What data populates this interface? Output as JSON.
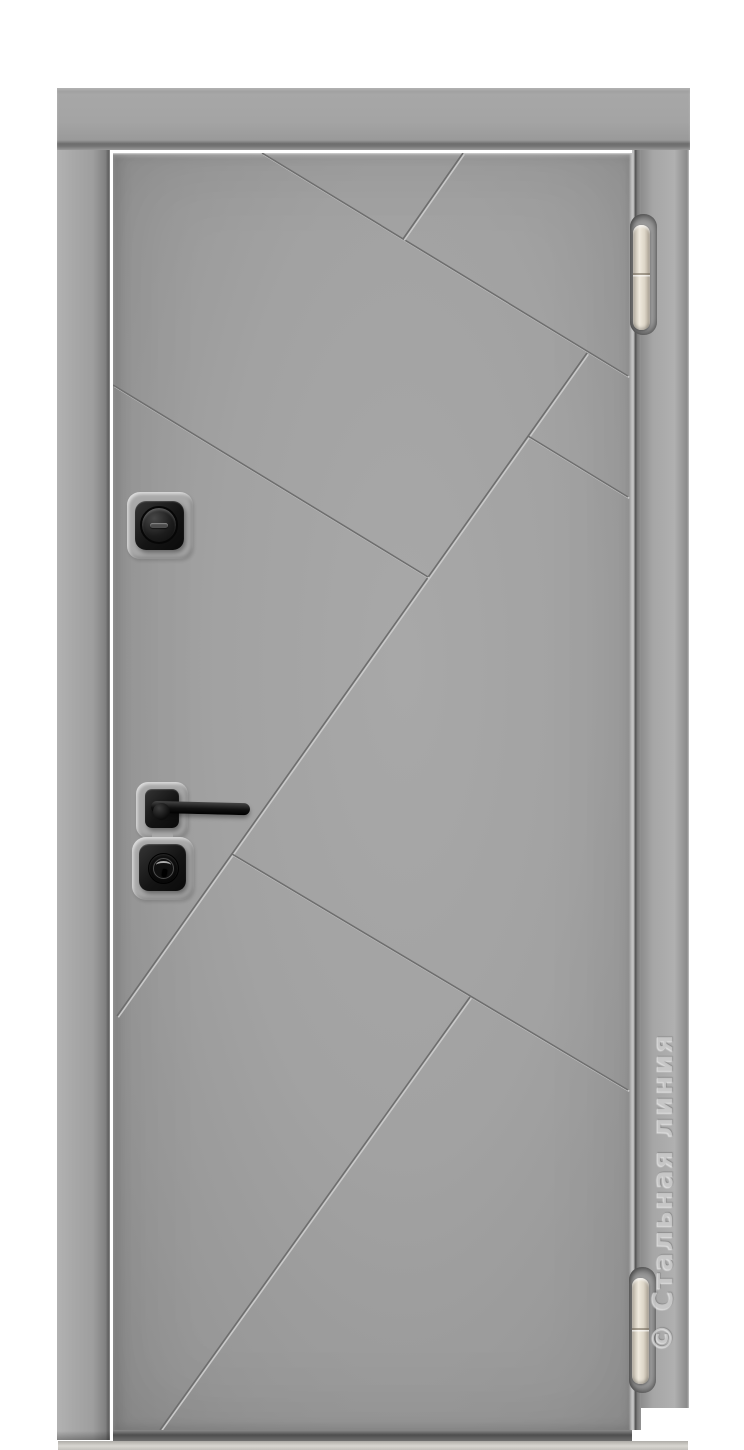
{
  "image": {
    "description": "Product photograph of a grey steel entrance door, exterior side, with diagonal milled groove pattern",
    "background_color": "#ffffff"
  },
  "watermark": {
    "text": "© Стальная линия",
    "orientation": "vertical, reads bottom to top along right door frame",
    "color": "#e0e0e0"
  },
  "door": {
    "leaf_color": "#a0a0a0",
    "frame_color": "#a8a8a8",
    "groove_dark_color": "#6e6e6e",
    "groove_light_color": "#c9c9c9",
    "sill_color": "#d0cec9",
    "hardware_color": "#141414",
    "hinge_color": "#e9e3d7",
    "hinges": [
      {
        "id": "top",
        "position": "upper right"
      },
      {
        "id": "bottom",
        "position": "lower right"
      }
    ],
    "hardware": [
      {
        "id": "thumbturn-lock",
        "type": "night-lock thumbturn on square black escutcheon"
      },
      {
        "id": "door-handle",
        "type": "straight lever handle on square black rose"
      },
      {
        "id": "cylinder-lock",
        "type": "key cylinder on square black escutcheon"
      }
    ]
  },
  "pattern": {
    "grooves": [
      {
        "x1": 149,
        "y1": 0,
        "x2": 515,
        "y2": 223
      },
      {
        "x1": 290,
        "y1": 86,
        "x2": 350,
        "y2": 0
      },
      {
        "x1": 474,
        "y1": 200,
        "x2": 4,
        "y2": 863
      },
      {
        "x1": 0,
        "y1": 232,
        "x2": 315,
        "y2": 424
      },
      {
        "x1": 415,
        "y1": 283,
        "x2": 515,
        "y2": 344
      },
      {
        "x1": 119,
        "y1": 701,
        "x2": 515,
        "y2": 937
      },
      {
        "x1": 357,
        "y1": 844,
        "x2": 47,
        "y2": 1277
      }
    ]
  }
}
